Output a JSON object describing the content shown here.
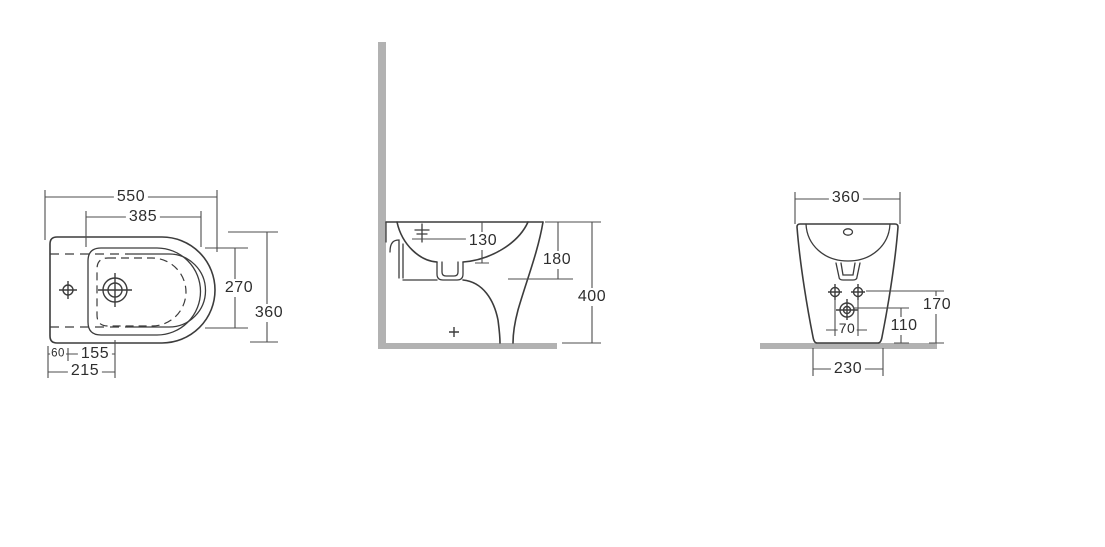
{
  "drawing": {
    "type": "bidet-technical-dimension-drawing",
    "colors": {
      "line": "#3c3c3c",
      "wall_floor": "#b2b2b2",
      "background": "#ffffff"
    }
  },
  "views": {
    "top": {
      "dims": {
        "overall_width": "550",
        "inner_width": "385",
        "inner_depth": "270",
        "overall_depth": "360",
        "edge_to_hole": "60",
        "hole_spacing": "155",
        "edge_to_tap": "215"
      }
    },
    "side": {
      "dims": {
        "rim_to_waterline": "130",
        "rim_to_outlet": "180",
        "overall_height": "400"
      }
    },
    "rear": {
      "dims": {
        "top_width": "360",
        "fixing_spacing": "70",
        "outlet_height": "110",
        "fixing_height": "170",
        "base_width": "230"
      }
    }
  }
}
